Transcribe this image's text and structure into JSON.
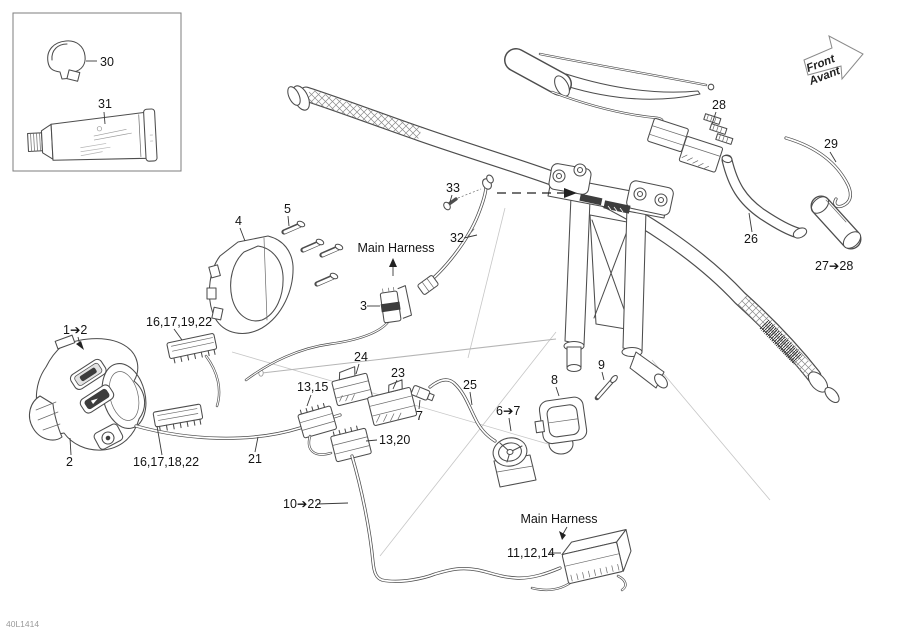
{
  "meta": {
    "doc_code": "40L1414"
  },
  "direction_arrow": {
    "line1": "Front",
    "line2": "Avant"
  },
  "annotations": {
    "main_harness_top": "Main Harness",
    "main_harness_bottom": "Main Harness"
  },
  "callouts": {
    "c30": "30",
    "c31": "31",
    "c1_2": "1➔2",
    "c2": "2",
    "c3": "3",
    "c4": "4",
    "c5": "5",
    "c6_7": "6➔7",
    "c7": "7",
    "c8": "8",
    "c9": "9",
    "c10_22": "10➔22",
    "c11_12_14": "11,12,14",
    "c13_15": "13,15",
    "c13_20": "13,20",
    "c16_17_18_22": "16,17,18,22",
    "c16_17_19_22": "16,17,19,22",
    "c21": "21",
    "c23": "23",
    "c24": "24",
    "c25": "25",
    "c26": "26",
    "c27_28": "27➔28",
    "c28": "28",
    "c29": "29",
    "c32": "32",
    "c33": "33"
  },
  "colors": {
    "background": "#ffffff",
    "line_ink": "#4d4d4d",
    "label_ink": "#141414"
  }
}
